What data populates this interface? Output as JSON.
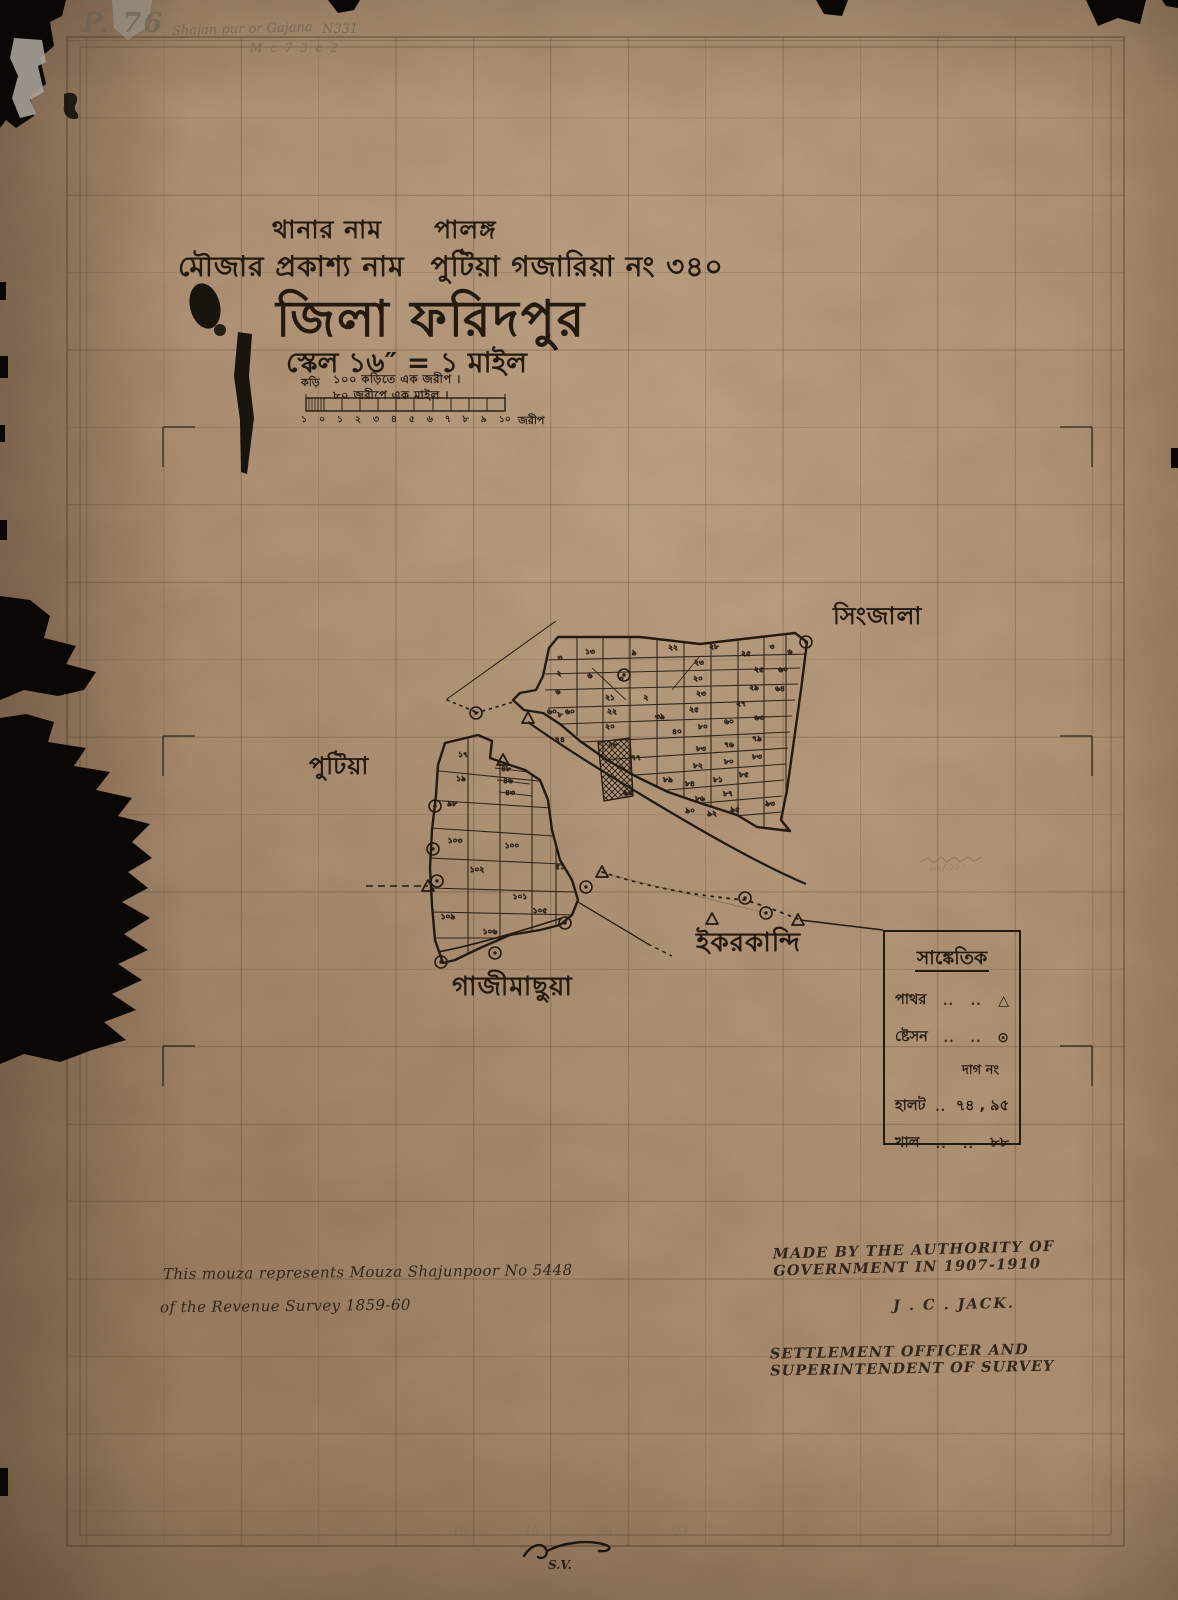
{
  "page": {
    "background": "#0a0705",
    "paper_color": "#b5977b",
    "ink_color": "#241a10",
    "pencil_color": "#6e6354"
  },
  "pencil_notes": {
    "catalog": "P. 76",
    "name_note": "Shajan pur or Gajana",
    "number_note": "N331",
    "sub_note": "M c 7        3 c 2",
    "fraction_note": "৬৬ / ১১১",
    "signature": "S.V.",
    "bottom_numbers": [
      {
        "t": "10",
        "x": 452
      },
      {
        "t": "15",
        "x": 524
      },
      {
        "t": "20",
        "x": 597
      },
      {
        "t": "23",
        "x": 673
      }
    ]
  },
  "title_block": {
    "thana_label": "থানার নাম",
    "thana_value": "পালঙ্গ",
    "mouza_label": "মৌজার প্রকাশ্য নাম",
    "mouza_value": "পুটিয়া  গজারিয়া  নং ৩৪০",
    "district_line": "জিলা ফরিদপুর",
    "scale_line": "স্কেল ১৬″ = ১ মাইল",
    "scale_note_1": "১০০ কড়িতে এক জরীপ ।",
    "scale_note_2": "৮০ জরীপে এক মাইল ।",
    "kori_label": "কড়ি",
    "bar_ticks": [
      "১",
      "০",
      "১",
      "২",
      "৩",
      "৪",
      "৫",
      "৬",
      "৭",
      "৮",
      "৯",
      "১০"
    ],
    "bar_unit": "জরীপ"
  },
  "villages": [
    {
      "name": "সিংজালা"
    },
    {
      "name": "পুটিয়া"
    },
    {
      "name": "ইকরকান্দি"
    },
    {
      "name": "গাজীমাছুয়া"
    }
  ],
  "legend": {
    "title": "সাঙ্কেতিক",
    "rows": [
      {
        "label": "পাথর",
        "dots_a": "..",
        "dots_b": "..",
        "symbol": "△"
      },
      {
        "label": "ষ্টেসন",
        "dots_a": "..",
        "dots_b": "..",
        "symbol": "⊙"
      },
      {
        "subhead": "দাগ নং"
      },
      {
        "label": "হালট",
        "dots_a": "..",
        "value": "৭৪ , ৯৫"
      },
      {
        "label": "খাল",
        "dots_a": "..",
        "dots_b": "..",
        "value": "৮৮"
      }
    ]
  },
  "notes": {
    "left_line1": "This mouza represents Mouza  Shajunpoor No 5448",
    "left_line2": "of the Revenue Survey 1859-60",
    "right_line1": "MADE BY THE AUTHORITY OF GOVERNMENT IN 1907-1910",
    "right_line2": "J . C . JACK.",
    "right_line3": "SETTLEMENT OFFICER AND SUPERINTENDENT OF SURVEY"
  },
  "map": {
    "plots": [
      {
        "n": "৩",
        "x": 560,
        "y": 660
      },
      {
        "n": "২",
        "x": 559,
        "y": 676
      },
      {
        "n": "৬",
        "x": 558,
        "y": 694
      },
      {
        "n": "৮",
        "x": 560,
        "y": 717
      },
      {
        "n": "১৩",
        "x": 590,
        "y": 654
      },
      {
        "n": "৯",
        "x": 634,
        "y": 655
      },
      {
        "n": "৬",
        "x": 590,
        "y": 678
      },
      {
        "n": "৩",
        "x": 621,
        "y": 681
      },
      {
        "n": "২২",
        "x": 673,
        "y": 650
      },
      {
        "n": "২৮",
        "x": 714,
        "y": 649
      },
      {
        "n": "২৩",
        "x": 699,
        "y": 665
      },
      {
        "n": "২০",
        "x": 698,
        "y": 681
      },
      {
        "n": "২৩",
        "x": 701,
        "y": 696
      },
      {
        "n": "২৫",
        "x": 694,
        "y": 712
      },
      {
        "n": "২৫",
        "x": 746,
        "y": 656
      },
      {
        "n": "৩",
        "x": 772,
        "y": 649
      },
      {
        "n": "২৫",
        "x": 759,
        "y": 672
      },
      {
        "n": "২৯",
        "x": 754,
        "y": 690
      },
      {
        "n": "২৭",
        "x": 741,
        "y": 706
      },
      {
        "n": "৬",
        "x": 790,
        "y": 654
      },
      {
        "n": "৬০",
        "x": 783,
        "y": 672
      },
      {
        "n": "৬৪",
        "x": 780,
        "y": 691
      },
      {
        "n": "৬০",
        "x": 552,
        "y": 714
      },
      {
        "n": "৬০",
        "x": 570,
        "y": 714
      },
      {
        "n": "২১",
        "x": 610,
        "y": 700
      },
      {
        "n": "২২",
        "x": 612,
        "y": 714
      },
      {
        "n": "২০",
        "x": 610,
        "y": 729
      },
      {
        "n": "২৮",
        "x": 613,
        "y": 747
      },
      {
        "n": "২",
        "x": 646,
        "y": 700
      },
      {
        "n": "৩৯",
        "x": 660,
        "y": 719
      },
      {
        "n": "৪০",
        "x": 677,
        "y": 734
      },
      {
        "n": "৮০",
        "x": 703,
        "y": 729
      },
      {
        "n": "৬০",
        "x": 729,
        "y": 724
      },
      {
        "n": "৬৩",
        "x": 759,
        "y": 720
      },
      {
        "n": "৮৩",
        "x": 701,
        "y": 751
      },
      {
        "n": "৭৬",
        "x": 729,
        "y": 747
      },
      {
        "n": "৭৯",
        "x": 757,
        "y": 741
      },
      {
        "n": "৮২",
        "x": 698,
        "y": 768
      },
      {
        "n": "৮০",
        "x": 729,
        "y": 764
      },
      {
        "n": "৮৩",
        "x": 757,
        "y": 759
      },
      {
        "n": "৮৪",
        "x": 690,
        "y": 786
      },
      {
        "n": "৮১",
        "x": 718,
        "y": 782
      },
      {
        "n": "৮৫",
        "x": 744,
        "y": 777
      },
      {
        "n": "৭৭",
        "x": 636,
        "y": 760
      },
      {
        "n": "৮৯",
        "x": 668,
        "y": 782
      },
      {
        "n": "৮৬",
        "x": 700,
        "y": 801
      },
      {
        "n": "৮৭",
        "x": 728,
        "y": 796
      },
      {
        "n": "৯৩",
        "x": 770,
        "y": 806
      },
      {
        "n": "৯০",
        "x": 690,
        "y": 813
      },
      {
        "n": "৯২",
        "x": 712,
        "y": 816
      },
      {
        "n": "৯৫",
        "x": 735,
        "y": 812
      },
      {
        "n": "১৭",
        "x": 463,
        "y": 757
      },
      {
        "n": "১৯",
        "x": 461,
        "y": 781
      },
      {
        "n": "৪৮",
        "x": 506,
        "y": 771
      },
      {
        "n": "৪৬",
        "x": 508,
        "y": 783
      },
      {
        "n": "৪৩",
        "x": 510,
        "y": 795
      },
      {
        "n": "৯৮",
        "x": 452,
        "y": 806
      },
      {
        "n": "১০৩",
        "x": 455,
        "y": 843
      },
      {
        "n": "১০০",
        "x": 512,
        "y": 848
      },
      {
        "n": "১০২",
        "x": 477,
        "y": 872
      },
      {
        "n": "৫১",
        "x": 560,
        "y": 869
      },
      {
        "n": "১০১",
        "x": 520,
        "y": 899
      },
      {
        "n": "১০৫",
        "x": 540,
        "y": 913
      },
      {
        "n": "১০৬",
        "x": 490,
        "y": 934
      },
      {
        "n": "১০৯",
        "x": 448,
        "y": 919
      },
      {
        "n": "৭৪",
        "x": 560,
        "y": 742
      },
      {
        "n": "৯৫",
        "x": 628,
        "y": 795
      }
    ],
    "stations": [
      [
        806,
        642
      ],
      [
        624,
        675
      ],
      [
        476,
        713
      ],
      [
        435,
        806
      ],
      [
        433,
        849
      ],
      [
        437,
        881
      ],
      [
        565,
        923
      ],
      [
        586,
        887
      ],
      [
        745,
        898
      ],
      [
        766,
        913
      ],
      [
        495,
        953
      ],
      [
        441,
        962
      ]
    ],
    "stones": [
      [
        528,
        718
      ],
      [
        503,
        760
      ],
      [
        428,
        886
      ],
      [
        602,
        872
      ],
      [
        712,
        919
      ],
      [
        798,
        920
      ]
    ]
  }
}
